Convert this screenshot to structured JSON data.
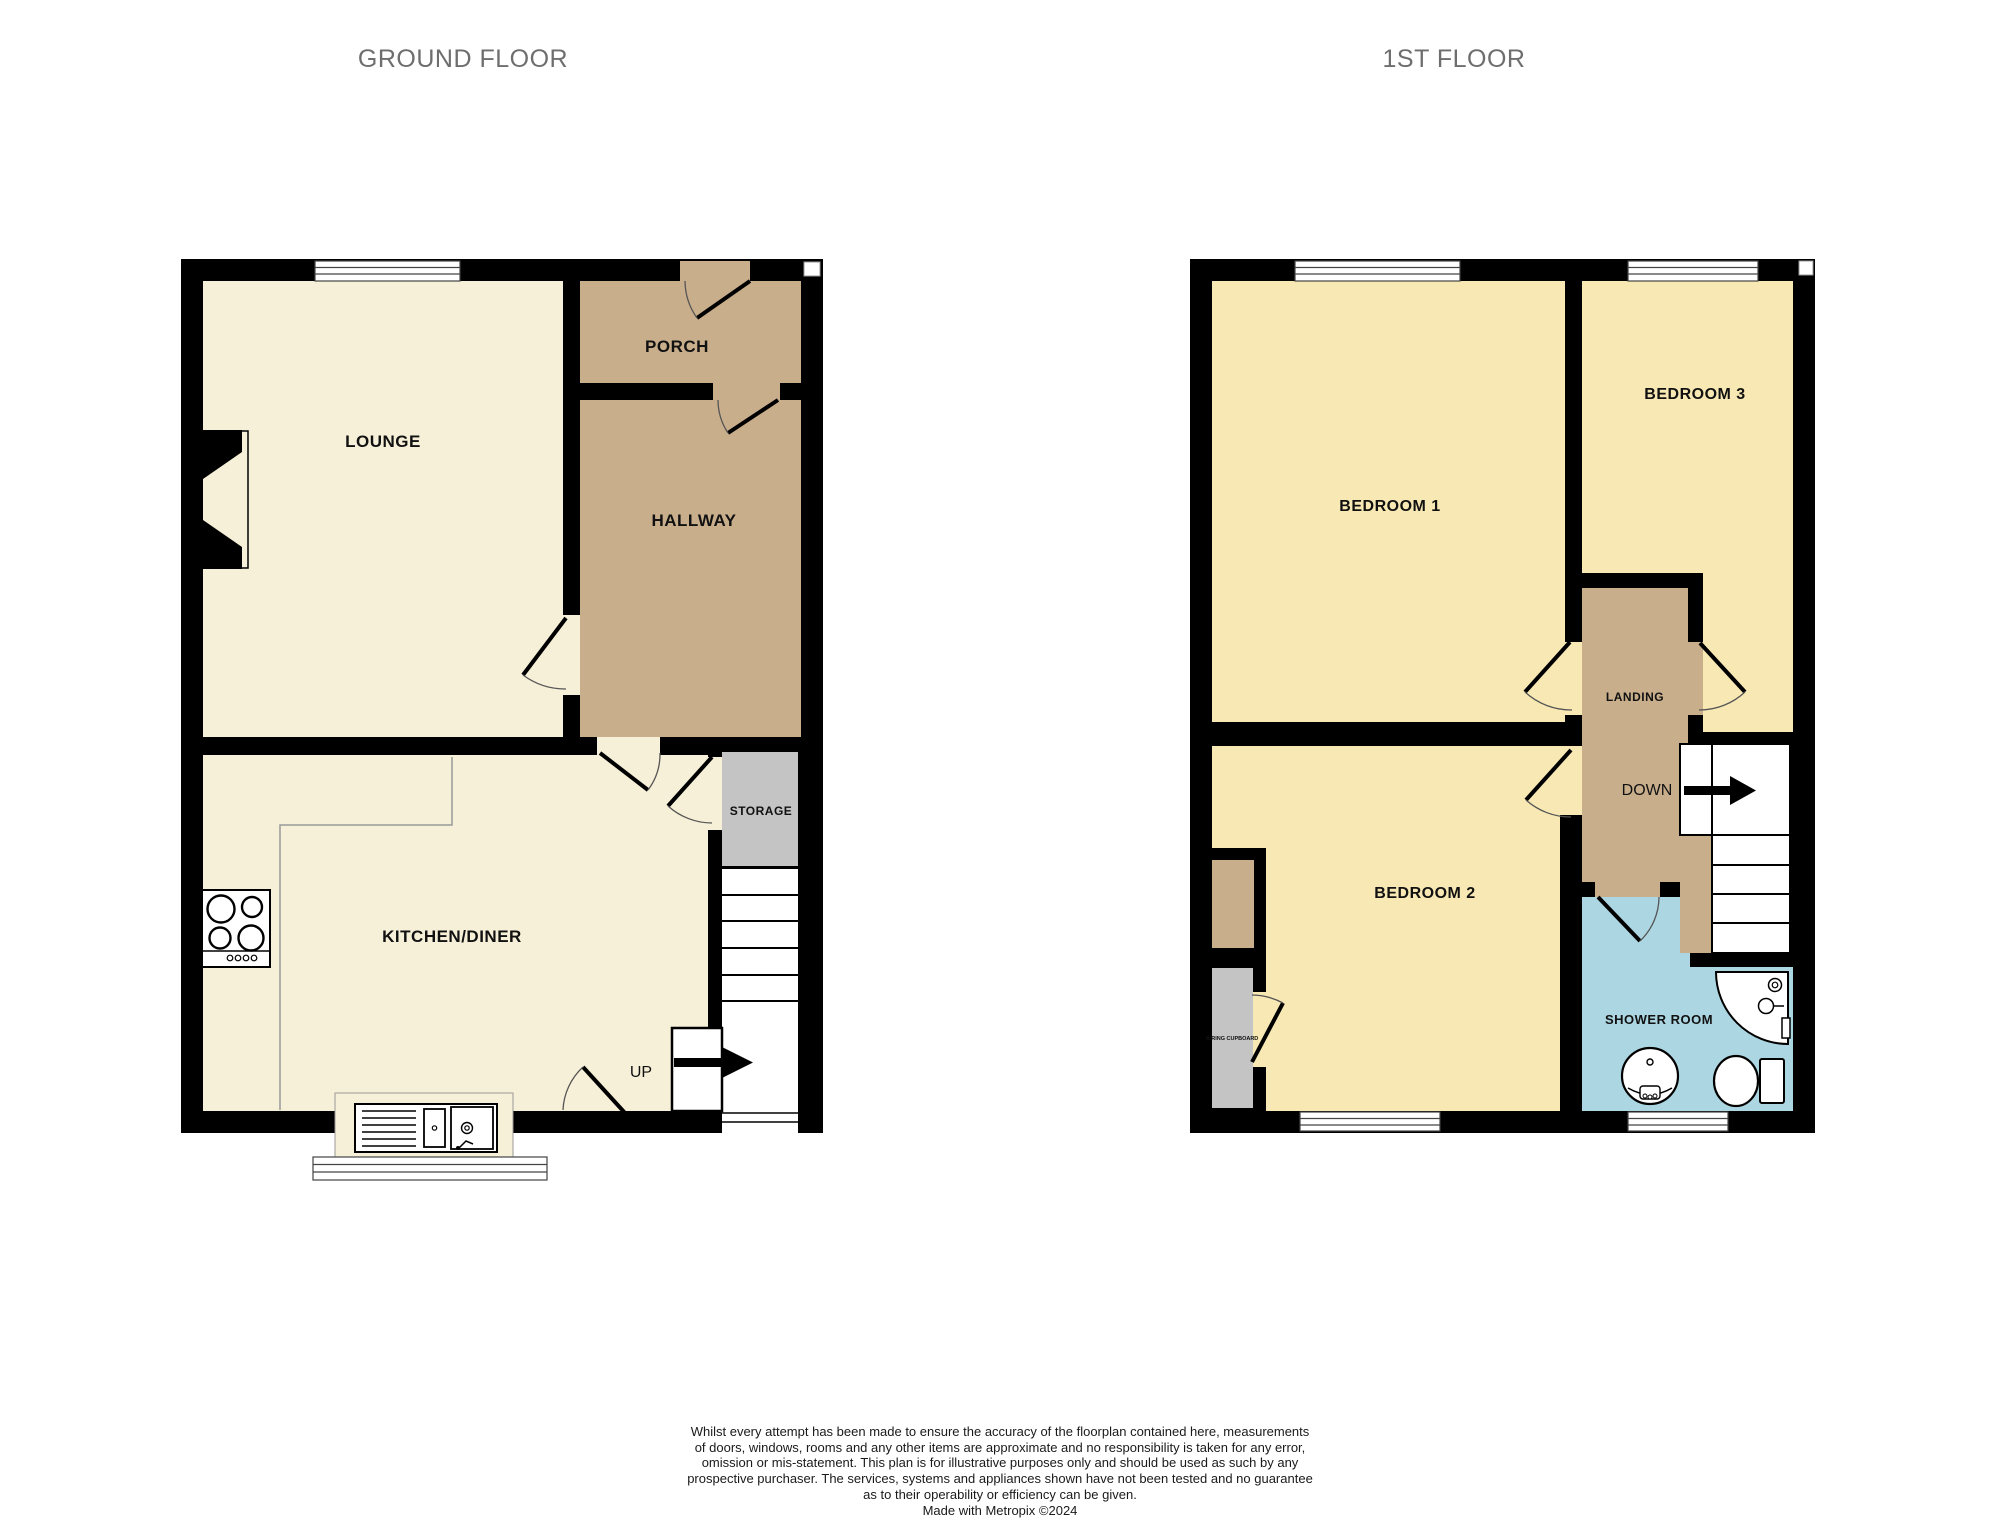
{
  "titles": {
    "ground": "GROUND FLOOR",
    "first": "1ST FLOOR"
  },
  "ground_floor": {
    "lounge": "LOUNGE",
    "porch": "PORCH",
    "hallway": "HALLWAY",
    "kitchen_diner": "KITCHEN/DINER",
    "storage": "STORAGE",
    "stairs": "UP"
  },
  "first_floor": {
    "bedroom1": "BEDROOM 1",
    "bedroom2": "BEDROOM 2",
    "bedroom3": "BEDROOM 3",
    "landing": "LANDING",
    "shower_room": "SHOWER ROOM",
    "airing_cupboard": "AIRING CUPBOARD",
    "stairs": "DOWN"
  },
  "footer": {
    "lines": [
      "Whilst every attempt has been made to ensure the accuracy of the floorplan contained here, measurements",
      "of doors, windows, rooms and any other items are approximate and no responsibility is taken for any error,",
      "omission or mis-statement. This plan is for illustrative purposes only and should be used as such by any",
      "prospective purchaser. The services, systems and appliances shown have not been tested and no guarantee",
      "as to their operability or efficiency can be given.",
      "Made with Metropix ©2024"
    ]
  },
  "colors": {
    "wall": "#000000",
    "ground_room": "#F7F0D8",
    "circulation": "#C9AE8C",
    "bedroom": "#F8E9B4",
    "storage": "#C4C4C4",
    "shower": "#ACD7E2",
    "title_gray": "#6E6E6E"
  }
}
